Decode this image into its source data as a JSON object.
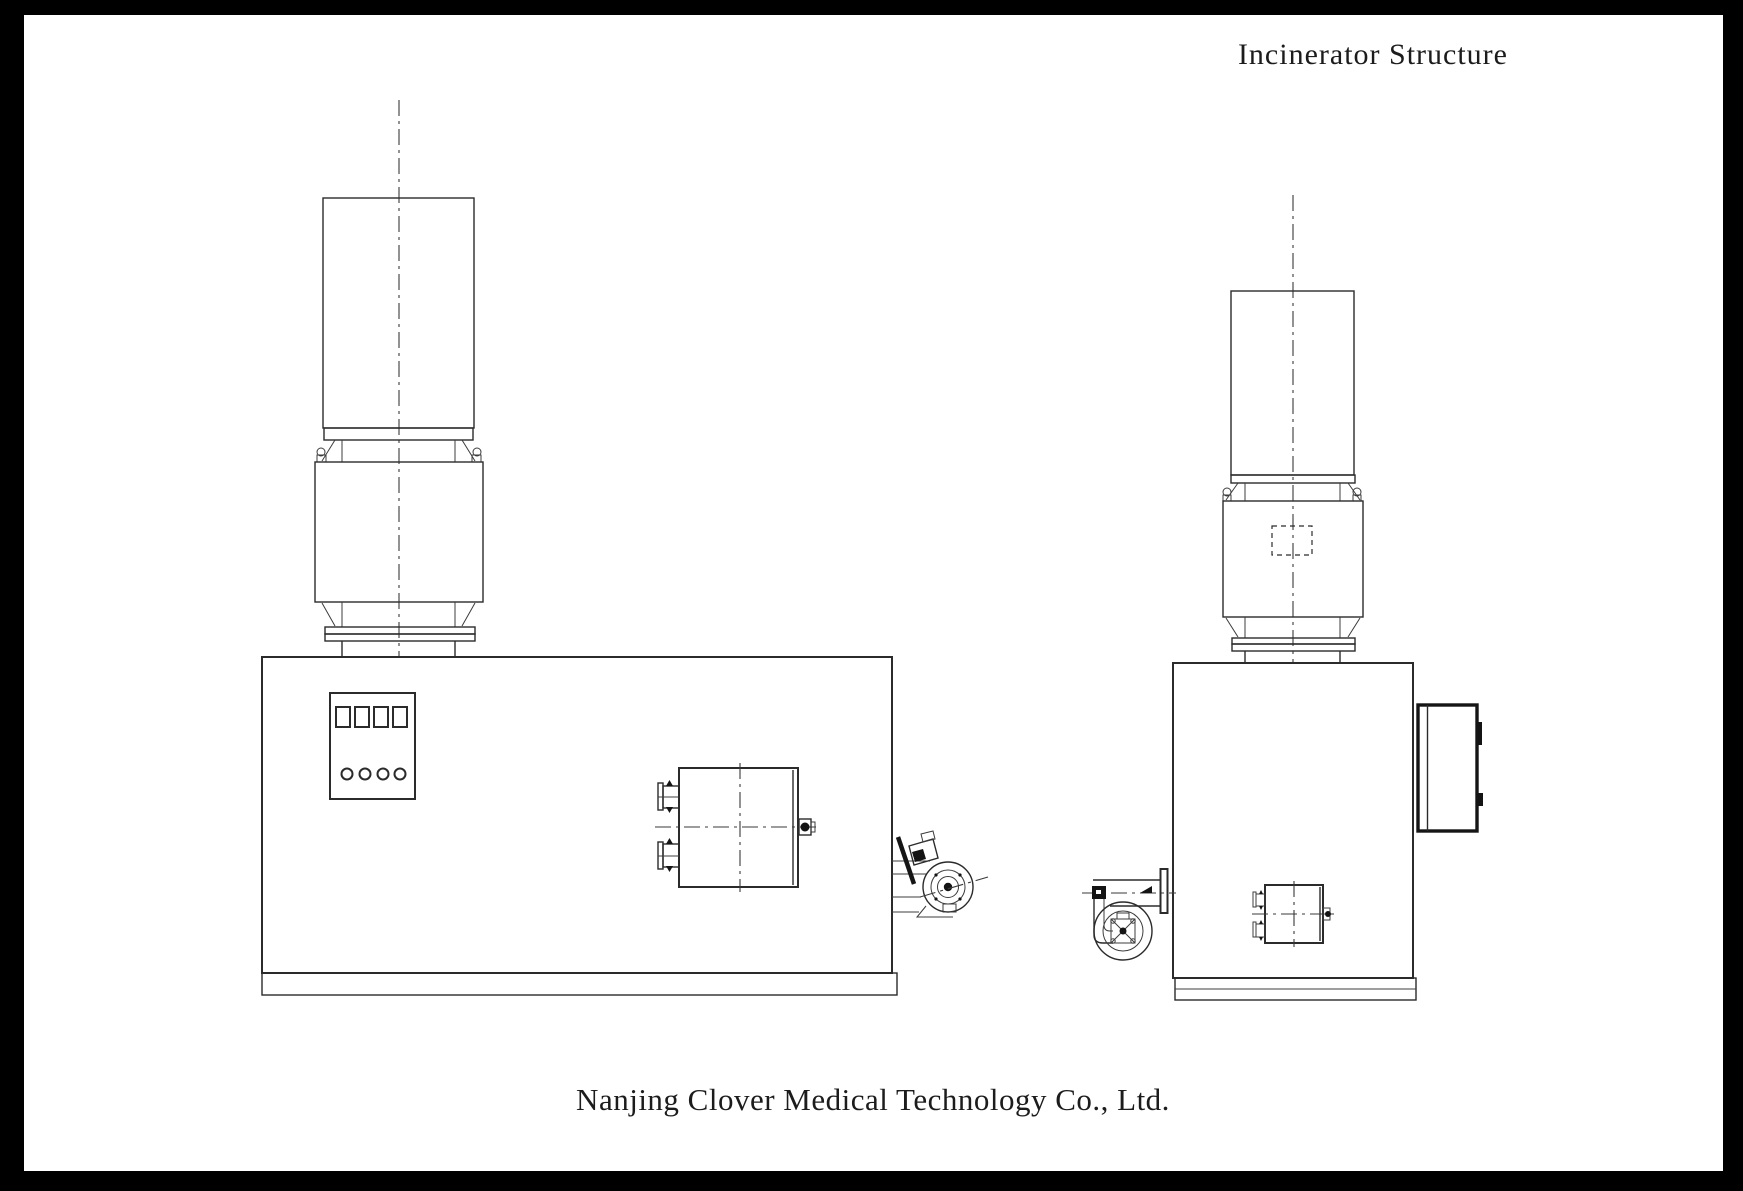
{
  "page": {
    "title": "Incinerator Structure",
    "caption": "Nanjing Clover Medical Technology Co., Ltd.",
    "colors": {
      "frame": "#000000",
      "paper": "#ffffff",
      "line": "#2b2b2b",
      "centerline": "#3a3a3a"
    }
  }
}
